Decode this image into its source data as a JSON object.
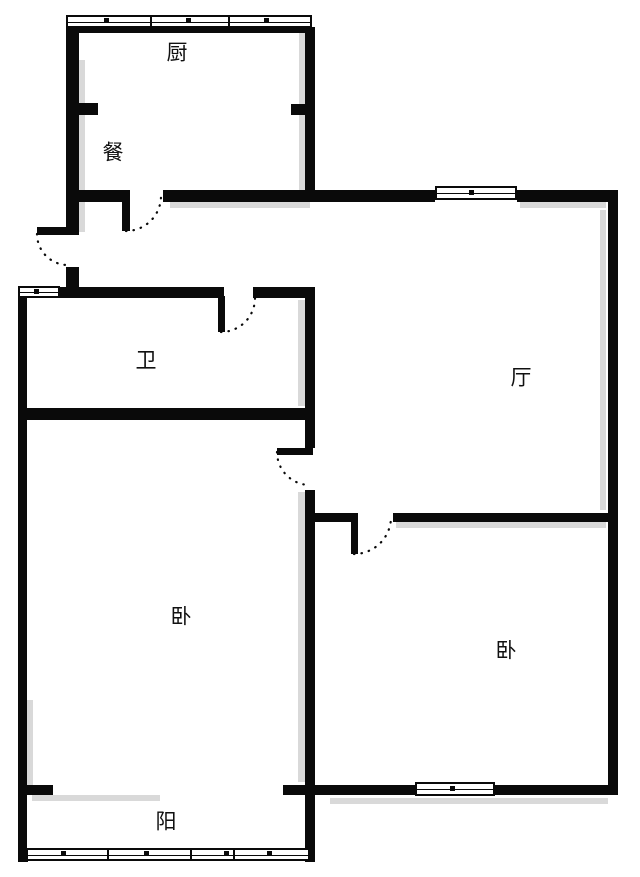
{
  "meta": {
    "type": "apartment-floor-plan",
    "background_color": "#ffffff",
    "wall_color": "#0a0a0a",
    "shadow_color": "#d9d9d9"
  },
  "rooms": {
    "kitchen": {
      "label": "厨"
    },
    "dining": {
      "label": "餐"
    },
    "bathroom": {
      "label": "卫"
    },
    "living": {
      "label": "厅"
    },
    "bedroom_left": {
      "label": "卧"
    },
    "bedroom_right": {
      "label": "卧"
    },
    "balcony": {
      "label": "阳"
    }
  }
}
